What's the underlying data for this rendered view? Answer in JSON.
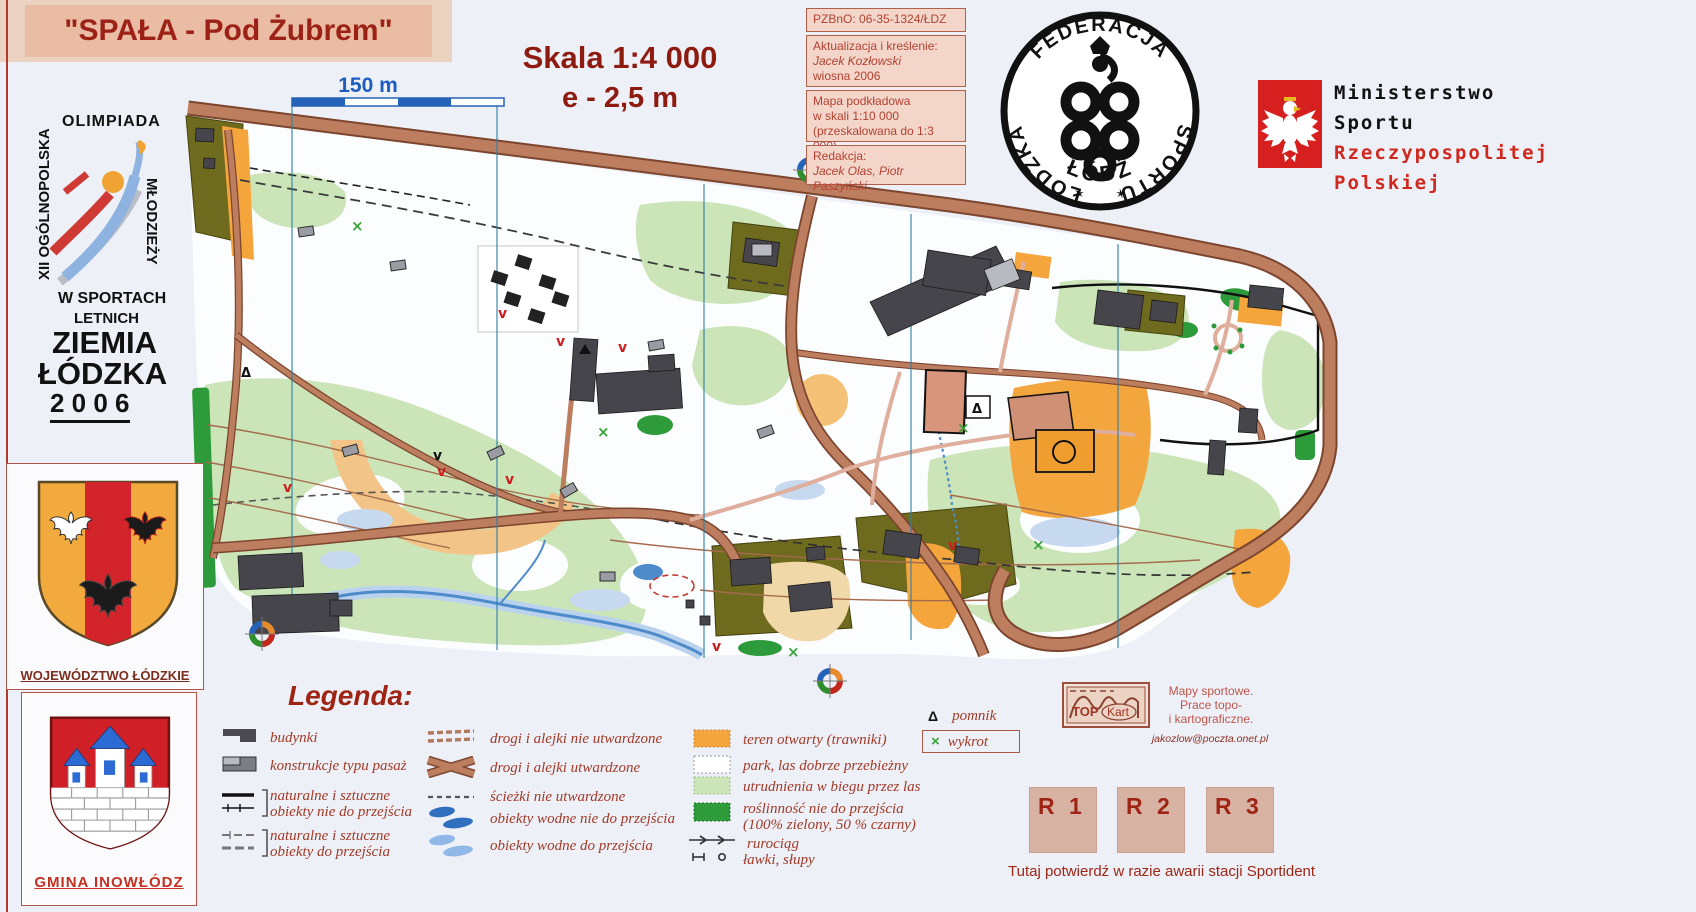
{
  "banner": {
    "title": "\"SPAŁA - Pod Żubrem\""
  },
  "scale_block": {
    "line1": "Skala  1:4 000",
    "line2": "e - 2,5 m"
  },
  "map": {
    "scale_bar_label": "150 m"
  },
  "info_boxes": {
    "box1": {
      "line1": "PZBnO: 06-35-1324/ŁDZ"
    },
    "box2": {
      "line1": "Aktualizacja i kreślenie:",
      "line2": "Jacek Kozłowski",
      "line3": "wiosna 2006"
    },
    "box3": {
      "line1": "Mapa podkładowa",
      "line2": "w skali 1:10 000",
      "line3": "(przeskalowana do 1:3 000)"
    },
    "box4": {
      "line1": "Redakcja:",
      "line2": "Jacek Olas, Piotr Paszyński"
    }
  },
  "stamp": {
    "arc_left": "ŁÓDZKA",
    "arc_top": "FEDERACJA",
    "arc_right": "SPORTU",
    "bottom": "ŁÓDŹ",
    "star_left": "✶",
    "star_right": "✶"
  },
  "ministry": {
    "line1": "Ministerstwo",
    "line2": "Sportu",
    "line3": "Rzeczypospolitej",
    "line4": "Polskiej"
  },
  "olympiad": {
    "left_vertical": "XII OGÓLNOPOLSKA",
    "top": "OLIMPIADA",
    "right_vertical": "MŁODZIEŻY",
    "line1": "W SPORTACH",
    "line2": "LETNICH",
    "line3": "ZIEMIA",
    "line4": "ŁÓDZKA",
    "line5": "2 0 0 6"
  },
  "emblems": {
    "voivodeship": "WOJEWÓDZTWO ŁÓDZKIE",
    "commune": "GMINA INOWŁÓDZ"
  },
  "legend": {
    "heading": "Legenda:",
    "col1": [
      {
        "label": "budynki"
      },
      {
        "label": "konstrukcje typu pasaż"
      },
      {
        "label": "naturalne i sztuczne\nobiekty nie do przejścia"
      },
      {
        "label": "naturalne i sztuczne\nobiekty do przejścia"
      }
    ],
    "col2": [
      {
        "label": "drogi i alejki nie utwardzone"
      },
      {
        "label": "drogi i alejki utwardzone"
      },
      {
        "label": "ścieżki nie utwardzone"
      },
      {
        "label": "obiekty wodne nie do przejścia"
      },
      {
        "label": "obiekty wodne do przejścia"
      }
    ],
    "col3": [
      {
        "label": "teren otwarty (trawniki)"
      },
      {
        "label": "park, las dobrze przebieżny"
      },
      {
        "label": "utrudnienia w biegu przez las"
      },
      {
        "label": "roślinność nie do przejścia\n(100% zielony, 50 % czarny)"
      },
      {
        "label": "rurociąg"
      },
      {
        "label": "ławki, słupy"
      }
    ],
    "extra": [
      {
        "symbol": "Δ",
        "label": "pomnik"
      },
      {
        "symbol": "×",
        "label": "wykrot"
      }
    ]
  },
  "topkart": {
    "logo_top": "TOP",
    "logo_kart": "Kart",
    "line1": "Mapy sportowe.",
    "line2": "Prace topo-",
    "line3": "i kartograficzne.",
    "email": "jakozlow@poczta.onet.pl"
  },
  "sportident": {
    "box1": "R 1",
    "box2": "R 2",
    "box3": "R 3",
    "note": "Tutaj potwierdź w razie awarii stacji Sportident"
  },
  "colors": {
    "accent_red": "#9e2414",
    "legend_text": "#a23a28",
    "road_brown": "#bd7d5f",
    "park_green": "#cbe5b8",
    "dense_green": "#2e9b3a",
    "olive": "#6e6a1e",
    "open_orange": "#f4a53c",
    "water_blue": "#4e8bca",
    "north_line": "#2f7fa8",
    "scale_blue": "#2563b8"
  }
}
